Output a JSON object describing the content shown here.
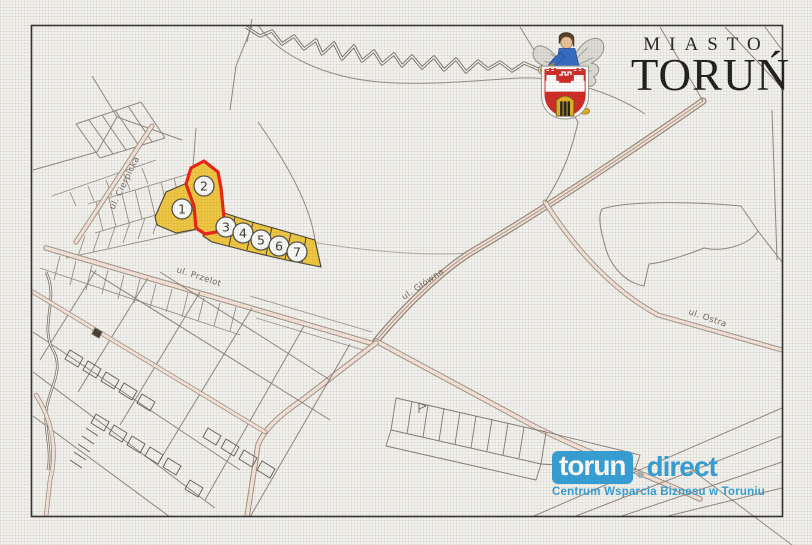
{
  "header": {
    "city_label": "MIASTO",
    "city_name": "TORUŃ"
  },
  "map": {
    "street_labels": {
      "cierpicka": "ul. Cierpicka",
      "przelot": "ul. Przelot",
      "glowna": "ul. Główna",
      "ostra": "ul. Ostra"
    },
    "parcels": [
      {
        "number": "1"
      },
      {
        "number": "2"
      },
      {
        "number": "3"
      },
      {
        "number": "4"
      },
      {
        "number": "5"
      },
      {
        "number": "6"
      },
      {
        "number": "7"
      }
    ],
    "colors": {
      "parcel_highlight": "#F0C63A",
      "parcel_outline_selected": "#EC1B0C",
      "road_fill": "#F5E4DA",
      "map_line": "#7B7166",
      "paper": "#F2F1ED",
      "frame": "#2A2A2A"
    }
  },
  "footer_logo": {
    "brand_primary": "torun",
    "brand_separator": ".",
    "brand_secondary": "direct",
    "tagline": "Centrum Wsparcia Biznesu w Toruniu",
    "brand_color": "#2D9DD6"
  }
}
